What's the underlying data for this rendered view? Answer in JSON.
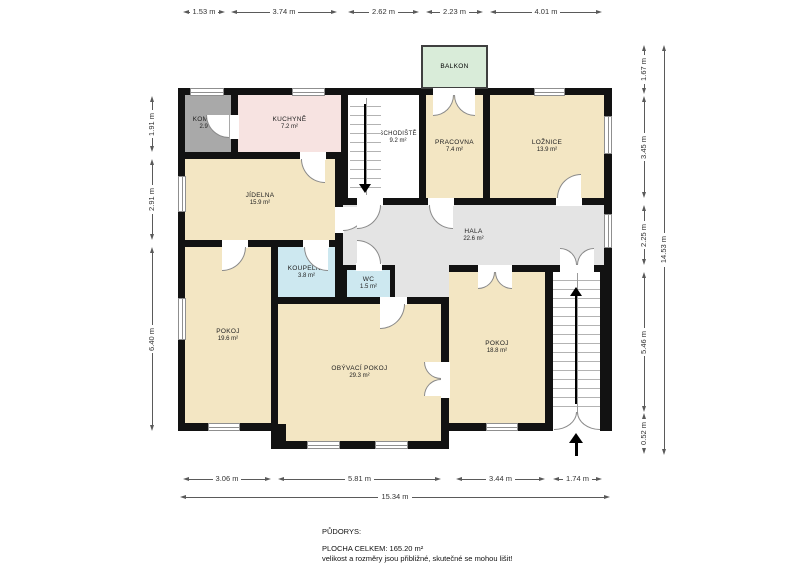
{
  "plan_title": "PŮDORYS:",
  "rooms": {
    "komora": {
      "name": "KOMORA",
      "area": "2.9 m²"
    },
    "kuchyne": {
      "name": "KUCHYNĚ",
      "area": "7.2 m²"
    },
    "jidelna": {
      "name": "JÍDELNA",
      "area": "15.9 m²"
    },
    "balkon": {
      "name": "BALKON"
    },
    "schodiste": {
      "name": "SCHODIŠTĚ",
      "area": "9.2 m²"
    },
    "pracovna": {
      "name": "PRACOVNA",
      "area": "7.4 m²"
    },
    "loznice": {
      "name": "LOŽNICE",
      "area": "13.9 m²"
    },
    "hala": {
      "name": "HALA",
      "area": "22.6 m²"
    },
    "koupelna": {
      "name": "KOUPELNA",
      "area": "3.8 m²"
    },
    "wc": {
      "name": "WC",
      "area": "1.5 m²"
    },
    "pokoj_levy": {
      "name": "POKOJ",
      "area": "19.6 m²"
    },
    "obyvaci": {
      "name": "OBÝVACÍ POKOJ",
      "area": "29.3 m²"
    },
    "pokoj_pravy": {
      "name": "POKOJ",
      "area": "18.8 m²"
    }
  },
  "dimensions": {
    "top": [
      "1.53 m",
      "3.74 m",
      "2.62 m",
      "2.23 m",
      "4.01 m"
    ],
    "bottom": [
      "3.06 m",
      "5.81 m",
      "3.44 m",
      "1.74 m"
    ],
    "bottom_total": "15.34 m",
    "left": [
      "1.91 m",
      "2.91 m",
      "6.40 m"
    ],
    "right": [
      "1.67 m",
      "3.45 m",
      "2.25 m",
      "5.46 m",
      "0.52 m"
    ],
    "right_total": "14.53 m"
  },
  "footer": {
    "title": "PŮDORYS:",
    "total": "PLOCHA CELKEM: 165.20 m²",
    "disclaimer": "velikost a rozměry jsou přibližné, skutečné se mohou lišit!"
  },
  "colors": {
    "wall": "#121212",
    "room_beige": "#f3e6c3",
    "room_gray": "#a9a9a9",
    "room_pink": "#f7e3e1",
    "room_blue": "#cde8f0",
    "hall_gray": "#e4e4e4",
    "balcony_green": "#d9ecd9"
  }
}
